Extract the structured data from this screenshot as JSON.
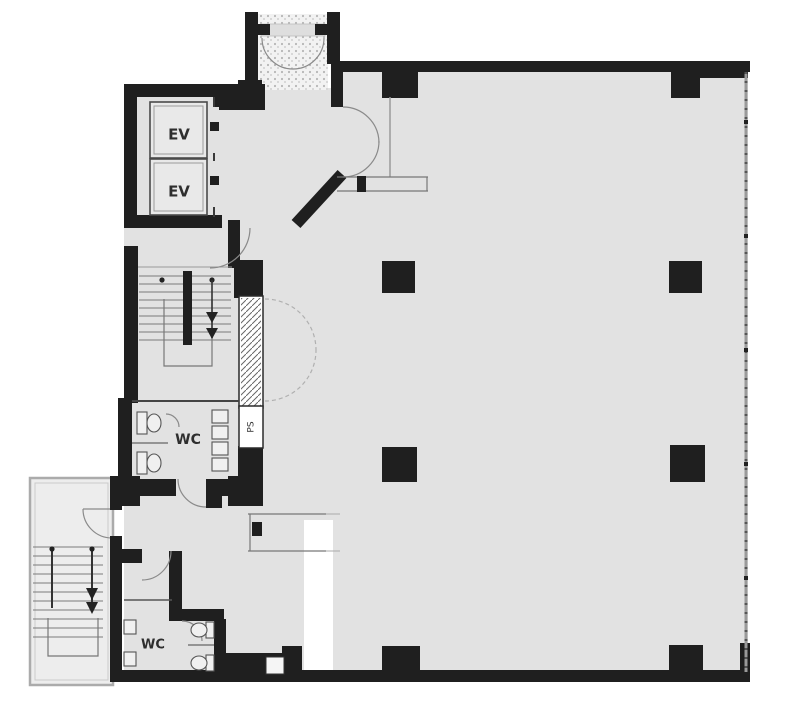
{
  "plan": {
    "kind": "building-floor-plan",
    "labels": {
      "elevator_top": "EV",
      "elevator_bottom": "EV",
      "wc_upper": "WC",
      "wc_lower": "WC",
      "pipe_shaft": "PS"
    },
    "colors": {
      "wall": "#1f1f1f",
      "room_floor": "#e2e2e2",
      "stair_enclosure": "#ededed",
      "outside": "#ffffff",
      "thin_line": "#777777",
      "window_wall": "#9a9a9a",
      "porch_dots": "#b5b5b5"
    }
  }
}
